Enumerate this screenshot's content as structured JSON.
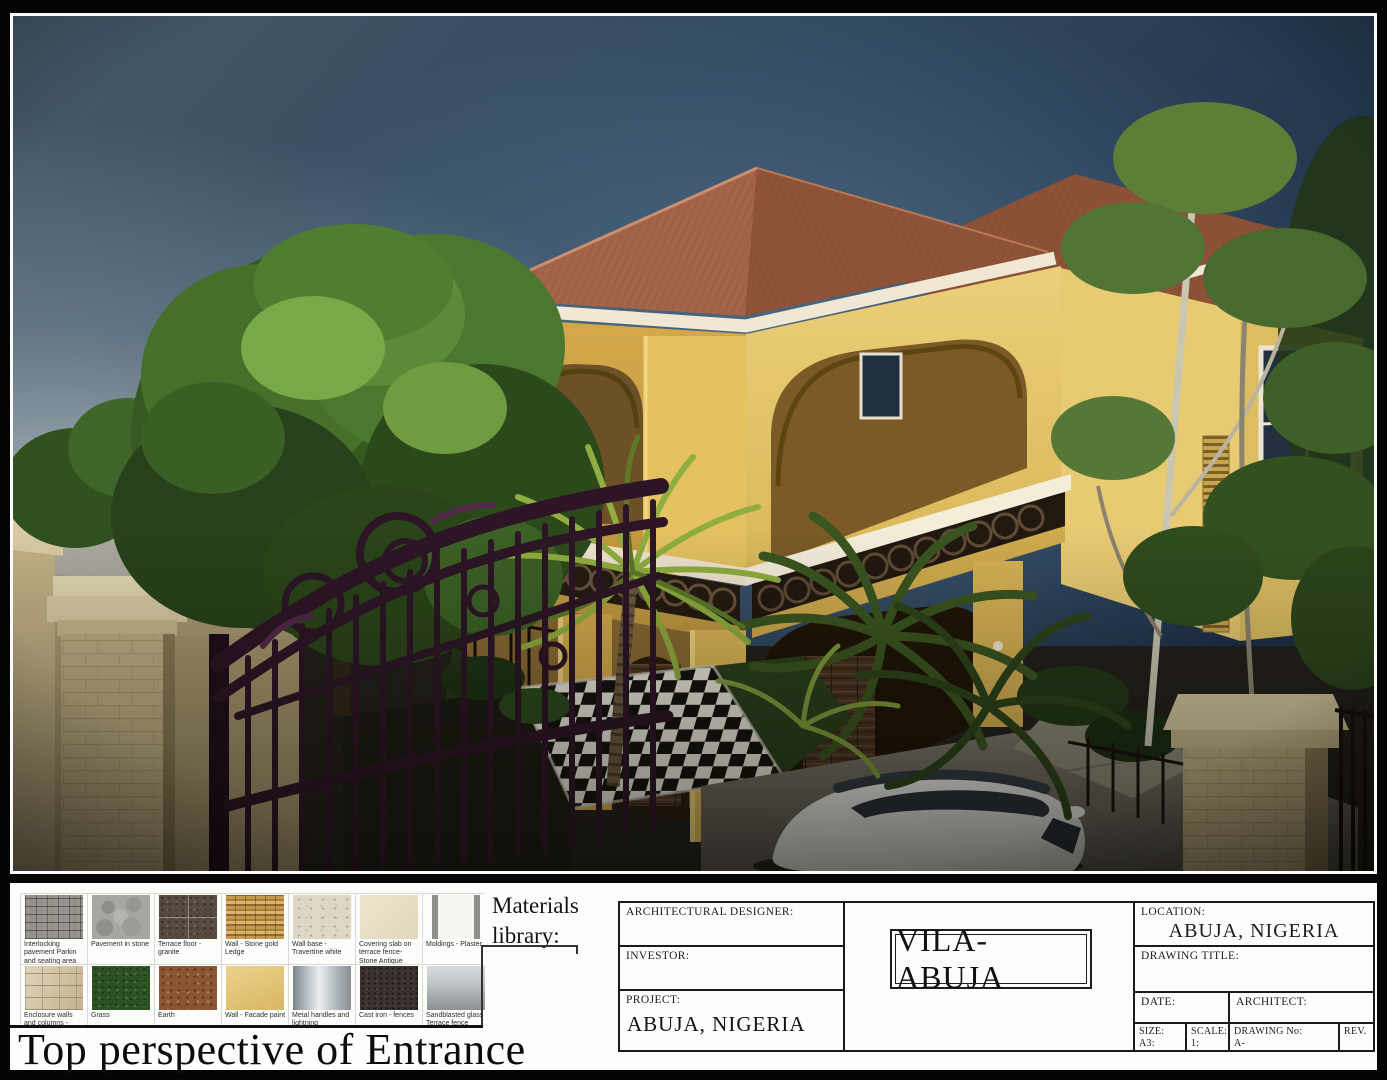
{
  "page": {
    "materials_library_label": "Materials library:",
    "sheet_title": "Top perspective of Entrance"
  },
  "materials": {
    "items": [
      {
        "label": "Interlocking pavement Parkin and seating area",
        "key": "interlock"
      },
      {
        "label": "Pavement in stone",
        "key": "stonepave"
      },
      {
        "label": "Terrace floor - granite",
        "key": "granite"
      },
      {
        "label": "Wall - Stone gold Ledge",
        "key": "goldledge"
      },
      {
        "label": "Wall base - Travertine white",
        "key": "travertine"
      },
      {
        "label": "Covering slab on terrace fence- Stone Antique White",
        "key": "coverslab"
      },
      {
        "label": "Moldings - Plaster",
        "key": "plaster"
      },
      {
        "label": "Enclosure walls and columns - Tallish stone",
        "key": "tallish"
      },
      {
        "label": "Grass",
        "key": "grass"
      },
      {
        "label": "Earth",
        "key": "earth"
      },
      {
        "label": "Wall - Facade paint",
        "key": "facade"
      },
      {
        "label": "Metal handles and lightning",
        "key": "metal"
      },
      {
        "label": "Cast iron - fences",
        "key": "castiron"
      },
      {
        "label": "Sandblasted glass Terrace fence",
        "key": "sandglass"
      }
    ]
  },
  "title_block": {
    "architectural_designer_label": "ARCHITECTURAL DESIGNER:",
    "investor_label": "INVESTOR:",
    "project_label": "PROJECT:",
    "project_value": "ABUJA, NIGERIA",
    "center_title": "VILA-ABUJA",
    "location_label": "LOCATION:",
    "location_value": "ABUJA, NIGERIA",
    "drawing_title_label": "DRAWING  TITLE:",
    "date_label": "DATE:",
    "architect_label": "ARCHITECT:",
    "size_label": "SIZE:",
    "size_value": "A3:",
    "scale_label": "SCALE:",
    "scale_value": "1:",
    "drawing_no_label": "DRAWING No:",
    "drawing_no_value": "A-",
    "rev_label": "REV."
  },
  "colors": {
    "frame-black": "#050505",
    "paper-white": "#fcfcfb",
    "line-black": "#1a1a1a",
    "sky-top": "#46596a",
    "sky-deep": "#1c3048",
    "roof-terracotta": "#9a5f41",
    "wall-yellow": "#ddb75a",
    "cornice-white": "#f0e8d4",
    "foliage-green": "#4c772e",
    "palm-green": "#8fae3f",
    "gate-purple": "#2d1526",
    "stone-tan": "#c2b186",
    "drive-gray": "#7d786c",
    "car-white": "#efefed"
  }
}
